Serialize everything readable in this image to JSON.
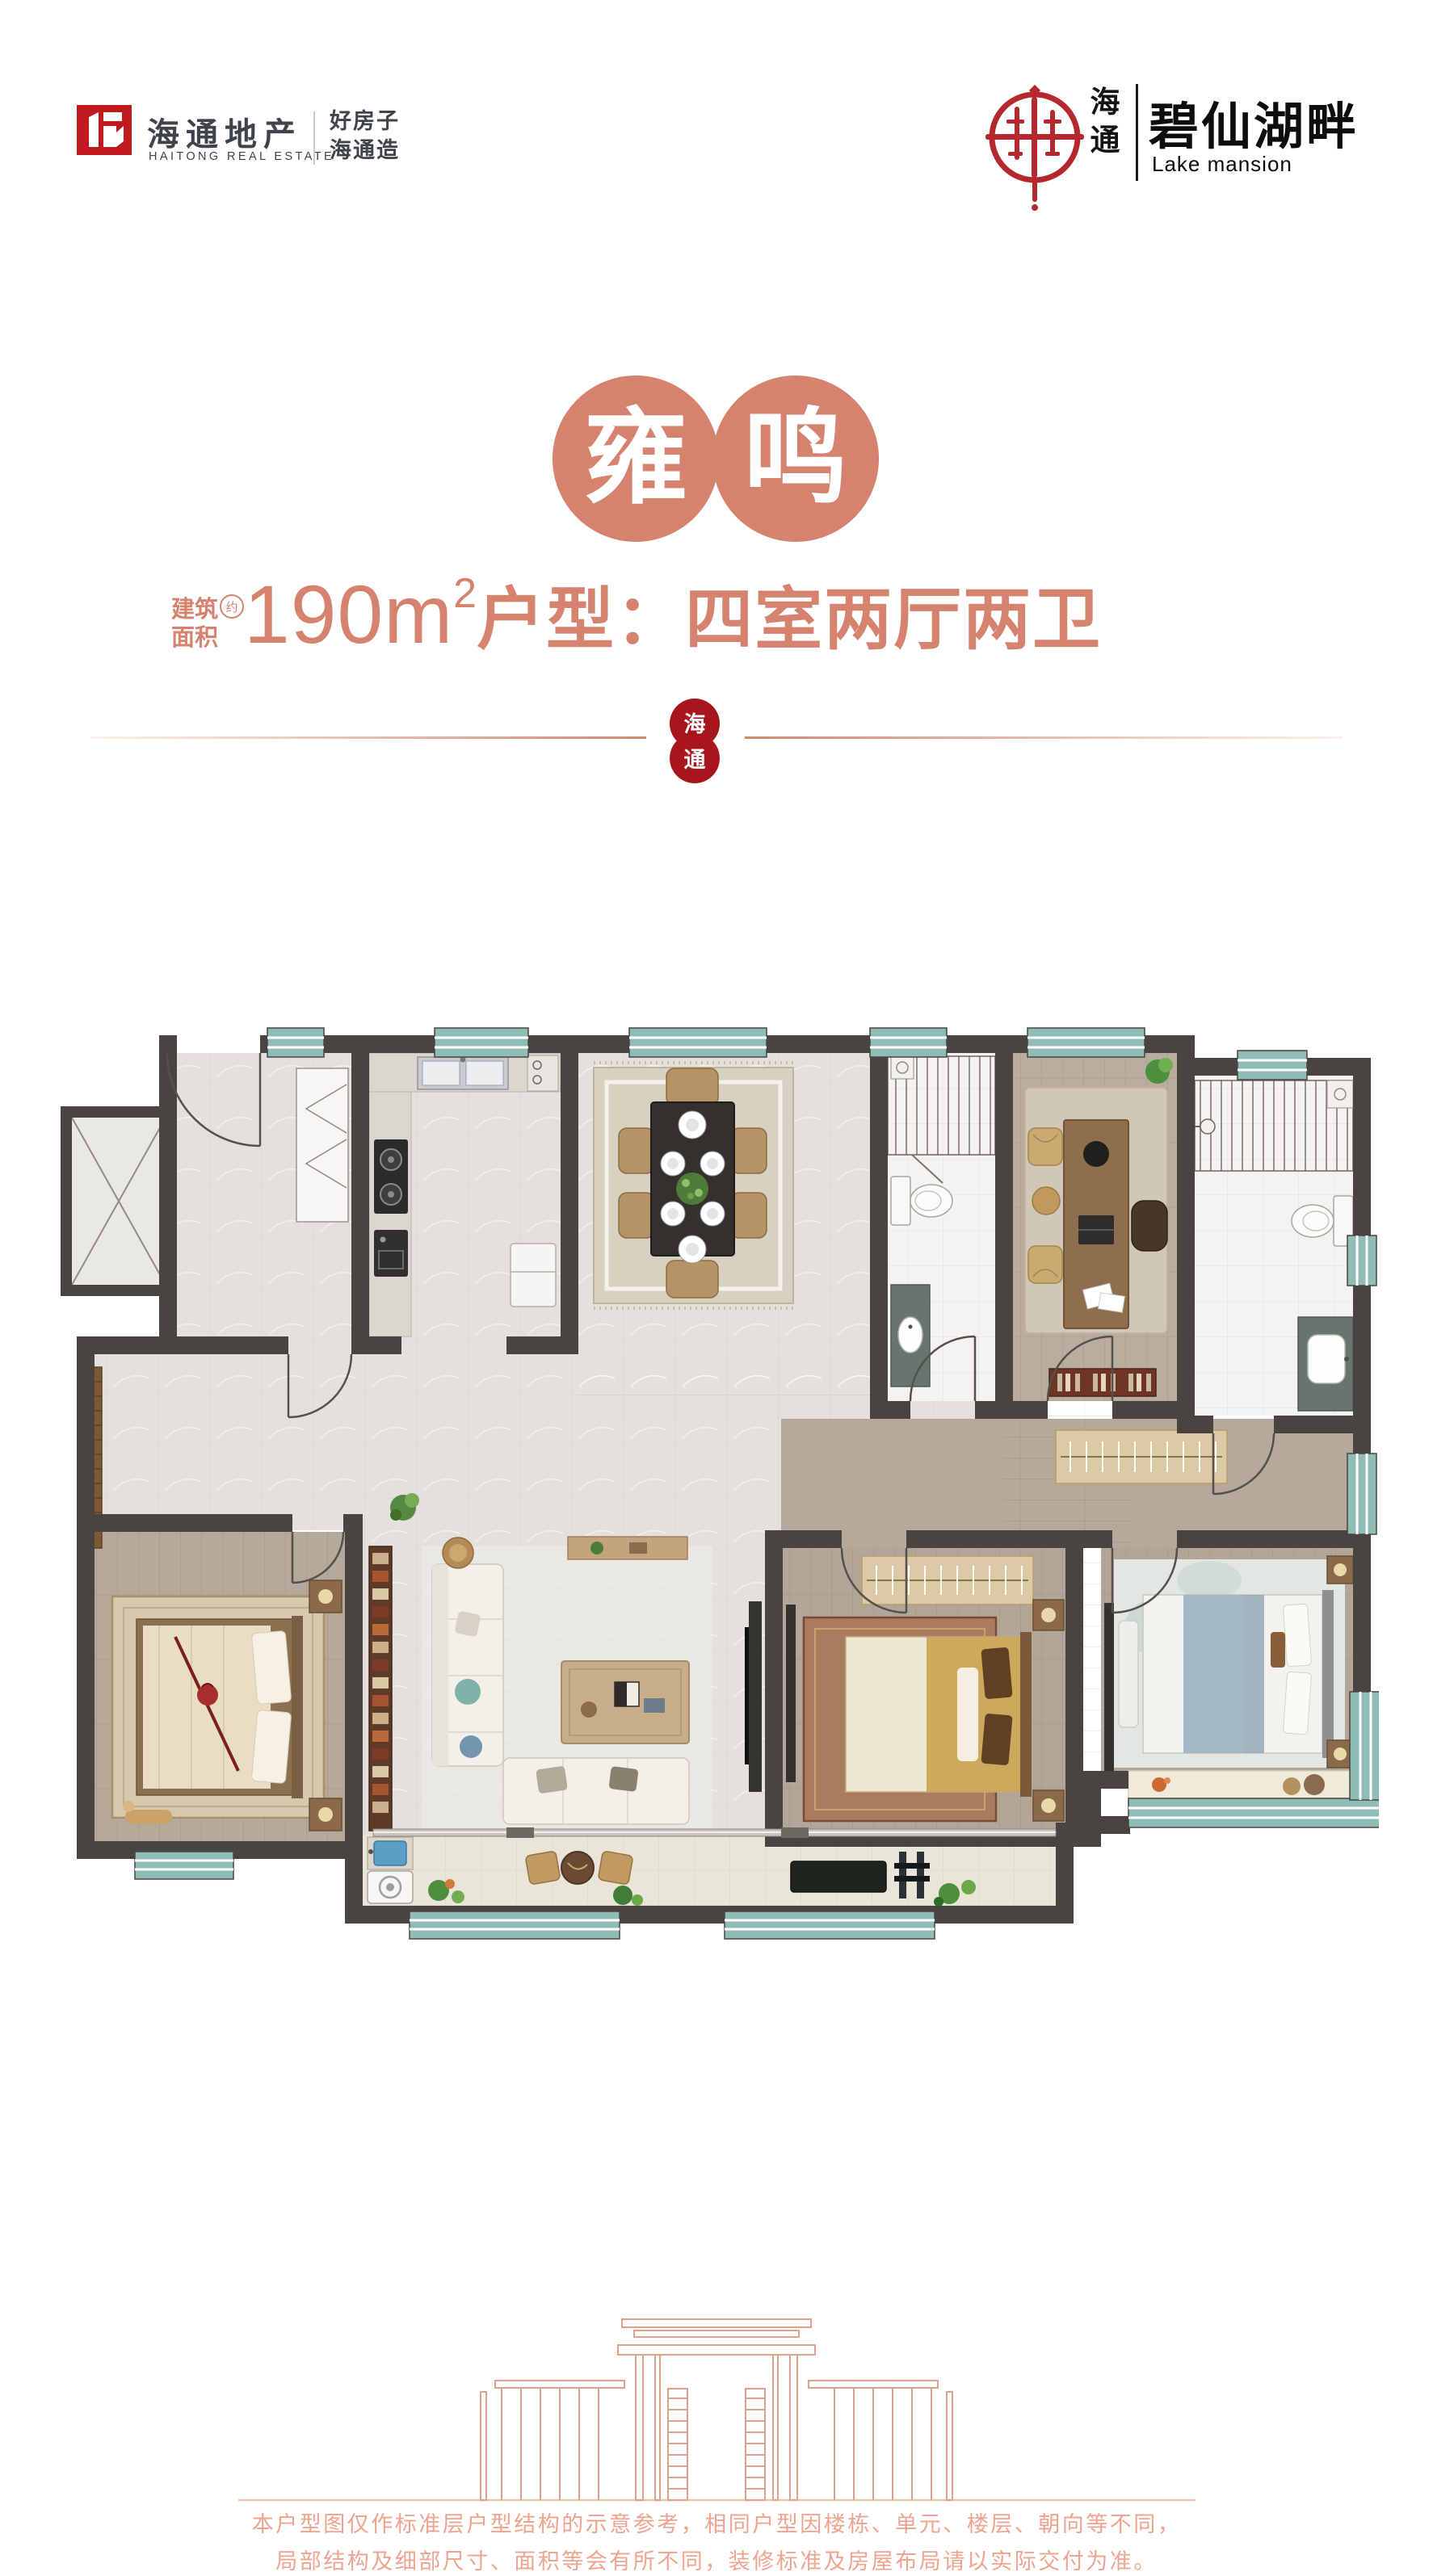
{
  "header": {
    "left_logo": {
      "name_cn": "海通地产",
      "name_en": "HAITONG REAL ESTATE",
      "tagline_line1": "好房子",
      "tagline_line2": "海通造",
      "brand_red": "#c01920",
      "text_color": "#3f444a"
    },
    "right_logo": {
      "brand_char1": "海",
      "brand_char2": "通",
      "project_cn": "碧仙湖畔",
      "project_en": "Lake mansion",
      "seal_color": "#b5282e"
    }
  },
  "title": {
    "char1": "雍",
    "char2": "鸣",
    "circle_color": "#d5826e"
  },
  "spec": {
    "label_line1": "建筑",
    "label_line2": "面积",
    "approx": "约",
    "area_value": "190",
    "area_unit": "m",
    "area_sup": "2",
    "layout_text": "户型：四室两厅两卫",
    "accent_color": "#d5826e"
  },
  "divider": {
    "seal_char1": "海",
    "seal_char2": "通",
    "seal_color": "#a8161d",
    "line_color": "#cf8a73"
  },
  "floor_plan": {
    "type": "architectural-floor-plan",
    "rooms": [
      "entry",
      "kitchen",
      "dining-room",
      "bathroom",
      "study",
      "master-bathroom",
      "bedroom-left",
      "living-room",
      "bedroom-middle",
      "master-bedroom",
      "balcony",
      "elevator"
    ],
    "palette": {
      "wall": "#4a4441",
      "window_teal": "#8fbcb5",
      "marble_floor": "#e4e1dc",
      "wood_floor": "#b5a99b",
      "bath_tile": "#f4f3f1",
      "balcony_tile": "#eae5d9"
    }
  },
  "footer": {
    "disclaimer_line1": "本户型图仅作标准层户型结构的示意参考，相同户型因楼栋、单元、楼层、朝向等不同，",
    "disclaimer_line2": "局部结构及细部尺寸、面积等会有所不同，装修标准及房屋布局请以实际交付为准。",
    "accent_color": "#efa48f"
  }
}
